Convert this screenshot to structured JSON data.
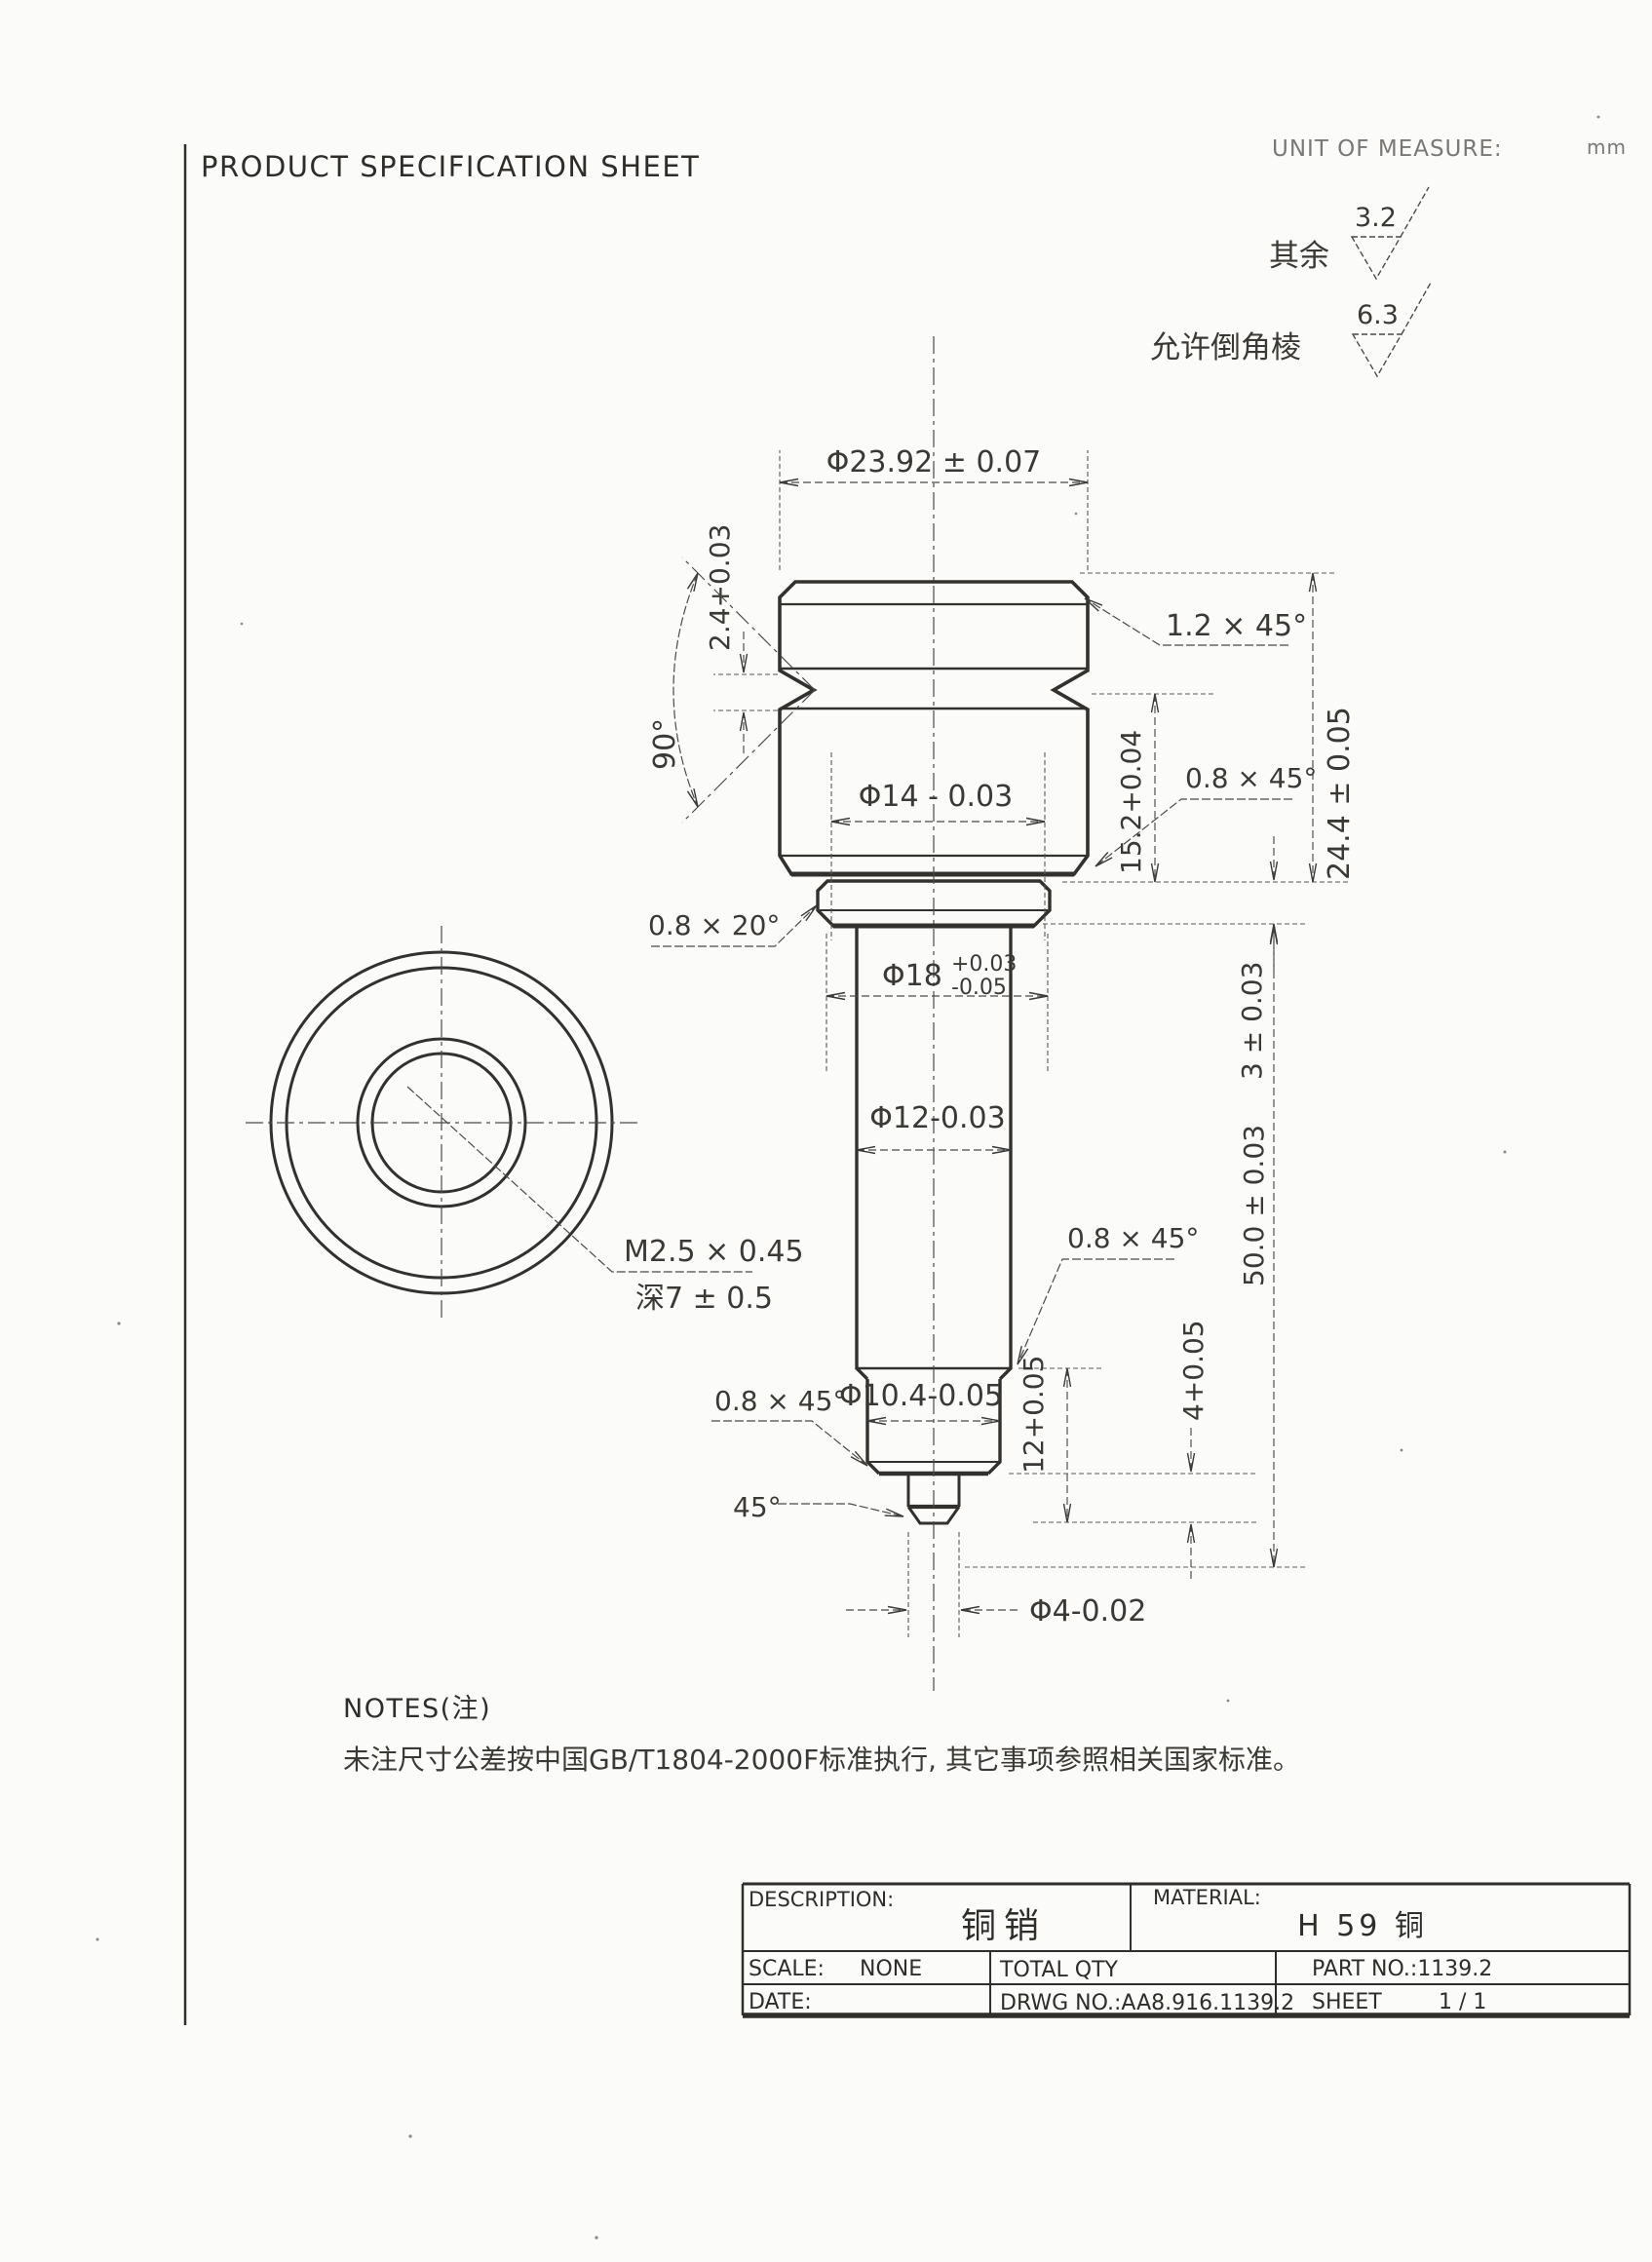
{
  "header": {
    "title": "PRODUCT SPECIFICATION SHEET",
    "unit_label": "UNIT OF MEASURE:",
    "unit_value": "mm"
  },
  "finish": {
    "rest_label": "其余",
    "rest_value": "3.2",
    "chamfer_label": "允许倒角棱",
    "chamfer_value": "6.3"
  },
  "dims": {
    "top_dia": "Φ23.92 ± 0.07",
    "groove_width": "2.4+0.03",
    "groove_angle": "90°",
    "head_chamfer": "1.2 × 45°",
    "overall_height": "24.4 ± 0.05",
    "band_height": "15.2+0.04",
    "head_bottom_chamfer": "0.8 × 45°",
    "flange_edge_chamfer": "0.8 × 20°",
    "inner_dia": "Φ14 - 0.03",
    "flange_dia": "Φ18",
    "flange_dia_upper": "+0.03",
    "flange_dia_lower": "-0.05",
    "flange_height": "3 ± 0.03",
    "shaft_dia": "Φ12-0.03",
    "shaft_length": "50.0 ± 0.03",
    "shaft_end_chamfer": "0.8 × 45°",
    "step_chamfer": "0.8 × 45°",
    "step_dia": "Φ10.4-0.05",
    "step_length": "12+0.05",
    "tip_length": "4+0.05",
    "tip_angle": "45°",
    "tip_dia": "Φ4-0.02",
    "thread_spec": "M2.5 × 0.45",
    "thread_depth": "深7 ± 0.5"
  },
  "notes": {
    "heading": "NOTES(注)",
    "body": "未注尺寸公差按中国GB/T1804-2000F标准执行, 其它事项参照相关国家标准。"
  },
  "title_block": {
    "description_label": "DESCRIPTION:",
    "description_value": "铜销",
    "material_label": "MATERIAL:",
    "material_value": "H 59 铜",
    "scale_label": "SCALE:",
    "scale_value": "NONE",
    "total_qty_label": "TOTAL QTY",
    "part_no": "PART NO.:1139.2",
    "date_label": "DATE:",
    "drwg_no": "DRWG NO.:AA8.916.1139.2",
    "sheet_label": "SHEET",
    "sheet_value": "1 / 1"
  }
}
